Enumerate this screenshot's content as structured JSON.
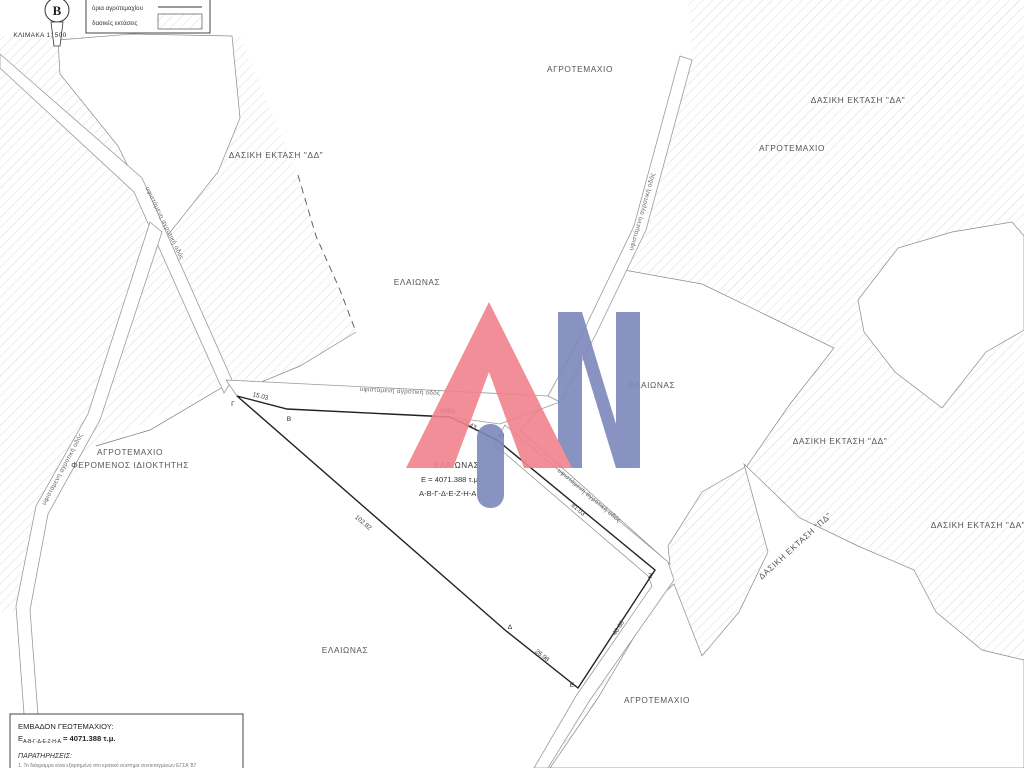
{
  "legend": {
    "scale": "ΚΛΙΜΑΚΑ 1: 500",
    "north_letter": "Β",
    "items": [
      {
        "label": "όρια αγροτεμαχίου",
        "symbol": "boundary-line"
      },
      {
        "label": "δασικές εκτάσεις",
        "symbol": "hatch-swatch"
      }
    ]
  },
  "road_label": "υφιστάμενη αγροτική οδός",
  "area_labels": {
    "agrotemaxio_top": "ΑΓΡΟΤΕΜΑΧΙΟ",
    "dasiki_da_top": "ΔΑΣΙΚΗ ΕΚΤΑΣΗ \"ΔΑ\"",
    "agrotemaxio_topright": "ΑΓΡΟΤΕΜΑΧΙΟ",
    "dasiki_dd_left": "ΔΑΣΙΚΗ ΕΚΤΑΣΗ \"ΔΔ\"",
    "elaionas_center": "ΕΛΑΙΩΝΑΣ",
    "elaionas_east": "ΕΛΑΙΩΝΑΣ",
    "agrotemaxio_left_line1": "ΑΓΡΟΤΕΜΑΧΙΟ",
    "agrotemaxio_left_line2": "ΦΕΡΟΜΕΝΟΣ ΙΔΙΟΚΤΗΤΗΣ",
    "dasiki_dd_right": "ΔΑΣΙΚΗ ΕΚΤΑΣΗ \"ΔΔ\"",
    "dasiki_da_right": "ΔΑΣΙΚΗ ΕΚΤΑΣΗ \"ΔΑ\"",
    "dasiki_pd": "ΔΑΣΙΚΗ ΕΚΤΑΣΗ \"ΠΔ\"",
    "elaionas_bottom": "ΕΛΑΙΩΝΑΣ",
    "agrotemaxio_bottomright": "ΑΓΡΟΤΕΜΑΧΙΟ"
  },
  "parcel": {
    "label": "ΕΛΑΙΩΝΑΣ",
    "area_text": "Ε = 4071.388 τ.μ.",
    "vertex_sequence": "Α-Β-Γ-Δ-Ε-Ζ-Η-Α",
    "vertices": {
      "a": "Α",
      "b": "Β",
      "g": "Γ",
      "d": "Δ",
      "e": "Ε",
      "z": "Ζ",
      "h": "Η"
    },
    "measurements": {
      "gb": "15.03",
      "ba": "48.58",
      "ah": "17.43",
      "hz": "81.03",
      "ze": "40.68",
      "de": "26.98",
      "gd": "102.82"
    }
  },
  "info_box": {
    "title": "ΕΜΒΑΔΟΝ ΓΕΩΤΕΜΑΧΙΟΥ:",
    "area_symbol": "Ε",
    "area_subscript": "Α-Β-Γ-Δ-Ε-Ζ-Η-Α",
    "area_value": " = 4071.388 τ.μ.",
    "remarks_title": "ΠΑΡΑΤΗΡΗΣΕΙΣ:",
    "remark_1": "1. Το διάγραμμα είναι εξαρτημένο στο κρατικό σύστημα συντεταγμένων ΕΓΣΑ '87"
  },
  "colors": {
    "logo_red": "#f0828c",
    "logo_blue": "#7d88bb",
    "hatch_line": "#c4c4c4"
  }
}
